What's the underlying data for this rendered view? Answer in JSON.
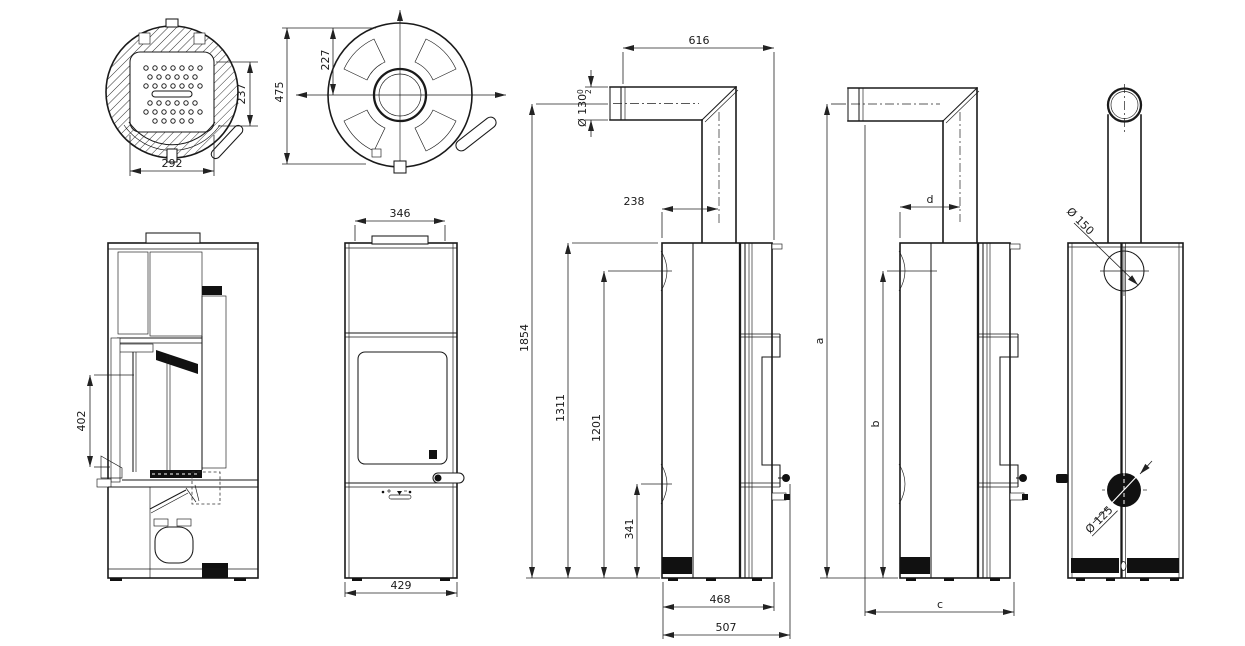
{
  "drawing": {
    "kind": "technical dimensional drawing",
    "subject": "cylindrical wood stove with flue connector",
    "line_color": "#1a1a1a",
    "background": "#ffffff"
  },
  "views": {
    "top_cross_section": {
      "label": "top cross-section",
      "dims": {
        "firebox_width": "292",
        "firebox_depth": "237"
      }
    },
    "top_view": {
      "label": "plan view",
      "dims": {
        "flue_center_offset": "227",
        "overall_depth": "475"
      }
    },
    "side_cross_section": {
      "label": "vertical cross-section",
      "dims": {
        "glass_height": "402"
      }
    },
    "front_view": {
      "label": "front elevation",
      "dims": {
        "top_diameter": "346",
        "base_width": "429"
      }
    },
    "side_elevation": {
      "label": "side elevation with flue connector",
      "dims": {
        "connector_reach": "616",
        "flue_pipe_diameter": "Ø 130",
        "flue_tol_upper": "0",
        "flue_tol_lower": "2",
        "flue_center_to_rear": "238",
        "overall_height": "1854",
        "body_height": "1311",
        "rear_outlet_height": "1201",
        "air_inlet_height": "341",
        "body_depth": "468",
        "overall_depth": "507"
      }
    },
    "side_elevation_vars": {
      "label": "side elevation variable dimensions",
      "dims": {
        "a": "a",
        "b": "b",
        "c": "c",
        "d": "d"
      }
    },
    "rear_view": {
      "label": "rear elevation",
      "dims": {
        "rear_flue_diameter": "Ø 150",
        "air_inlet_diameter": "Ø 125"
      }
    }
  }
}
